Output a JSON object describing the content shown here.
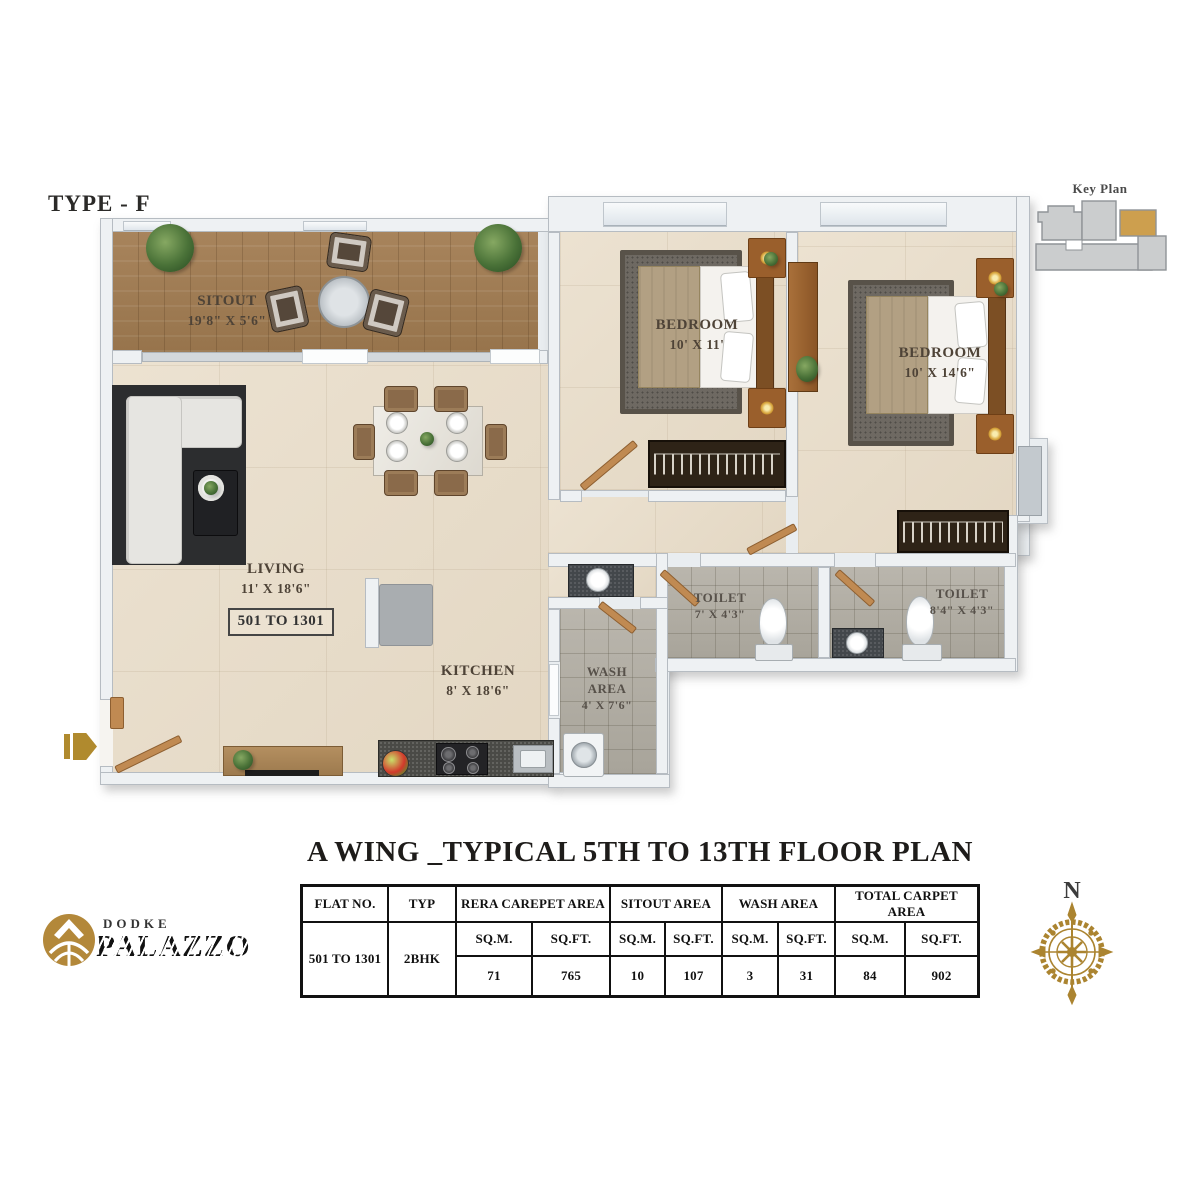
{
  "page": {
    "type_label": "TYPE - F",
    "title": "A WING _TYPICAL 5TH TO 13TH FLOOR PLAN"
  },
  "key_plan": {
    "label": "Key Plan"
  },
  "compass": {
    "north": "N"
  },
  "brand": {
    "name_line1": "DODKE",
    "name_line2": "PALAZZO"
  },
  "rooms": {
    "sitout": {
      "name": "SITOUT",
      "dim": "19'8\" X 5'6\""
    },
    "living": {
      "name": "LIVING",
      "dim": "11' X 18'6\"",
      "flat_range": "501 TO 1301"
    },
    "kitchen": {
      "name": "KITCHEN",
      "dim": "8' X 18'6\""
    },
    "wash": {
      "line1": "WASH",
      "line2": "AREA",
      "dim": "4' X 7'6\""
    },
    "bedroom1": {
      "name": "BEDROOM",
      "dim": "10' X 11'"
    },
    "bedroom2": {
      "name": "BEDROOM",
      "dim": "10' X 14'6\""
    },
    "toilet1": {
      "name": "TOILET",
      "dim": "7' X 4'3\""
    },
    "toilet2": {
      "name": "TOILET",
      "dim": "8'4\" X 4'3\""
    }
  },
  "table": {
    "headers": {
      "flat": "FLAT NO.",
      "typ": "TYP",
      "rera": "RERA CAREPET AREA",
      "sitout": "SITOUT AREA",
      "wash": "WASH AREA",
      "total": "TOTAL CARPET AREA"
    },
    "units": {
      "sqm": "SQ.M.",
      "sqft": "SQ.FT."
    },
    "row": {
      "flat": "501 TO 1301",
      "typ": "2BHK",
      "rera_sqm": "71",
      "rera_sqft": "765",
      "sitout_sqm": "10",
      "sitout_sqft": "107",
      "wash_sqm": "3",
      "wash_sqft": "31",
      "total_sqm": "84",
      "total_sqft": "902"
    }
  },
  "colors": {
    "gold_accent": "#b08a2e",
    "wall": "#eef1f3",
    "wood_floor": "#9c7a52",
    "beige_floor": "#e9dfcf",
    "tile_floor": "#b3afa5"
  }
}
